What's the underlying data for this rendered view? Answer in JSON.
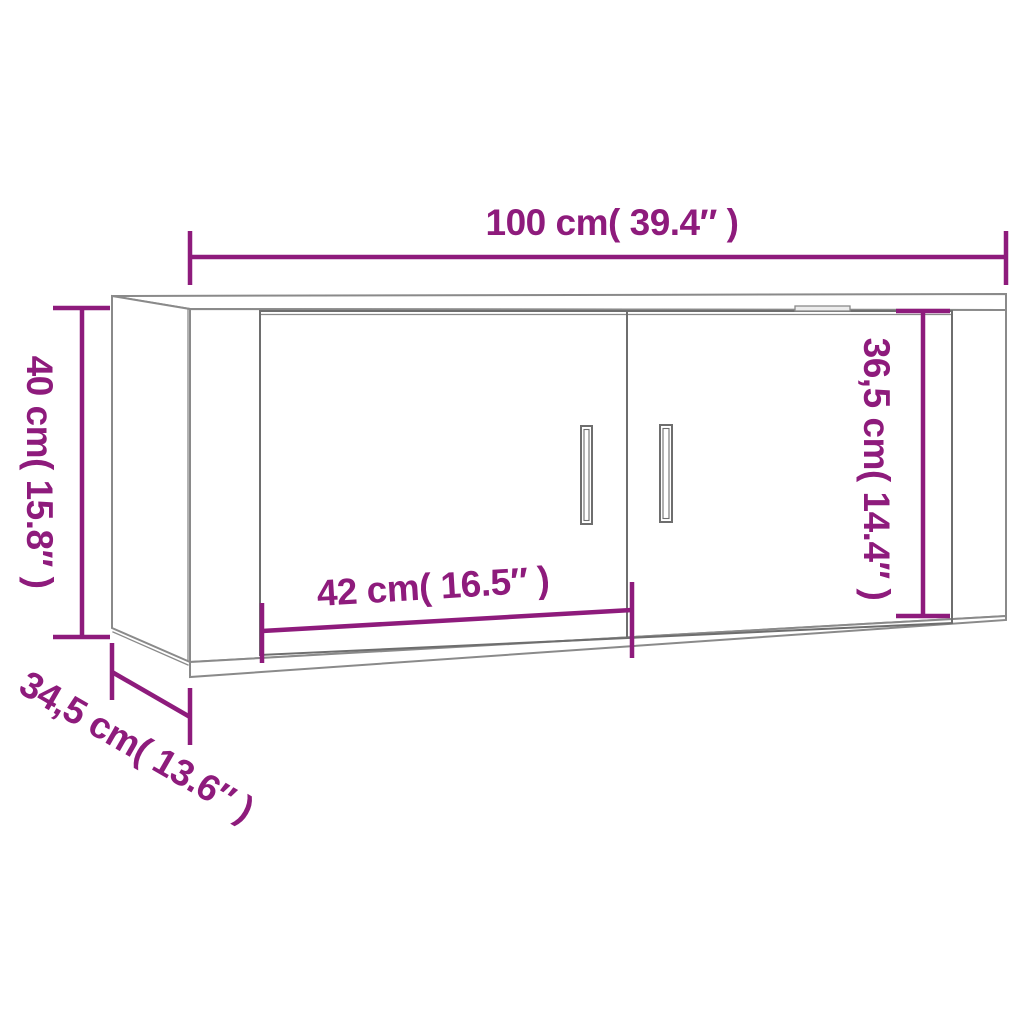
{
  "diagram": {
    "kind": "furniture-dimension-diagram",
    "subject": "wall-mounted-cabinet-two-doors",
    "colors": {
      "accent": "#8E1B7C",
      "line": "#8A8A8A",
      "detail": "#6E6E6E",
      "background": "#FFFFFF"
    },
    "dimensions": {
      "overall_width": {
        "label": "100 cm( 39.4″ )",
        "cm": 100,
        "inches": 39.4
      },
      "overall_height": {
        "label": "40 cm( 15.8″ )",
        "cm": 40,
        "inches": 15.8
      },
      "inner_height": {
        "label": "36,5 cm( 14.4″ )",
        "cm": 36.5,
        "inches": 14.4
      },
      "inner_width": {
        "label": "42 cm( 16.5″ )",
        "cm": 42,
        "inches": 16.5
      },
      "depth": {
        "label": "34,5 cm( 13.6″ )",
        "cm": 34.5,
        "inches": 13.6
      }
    }
  }
}
